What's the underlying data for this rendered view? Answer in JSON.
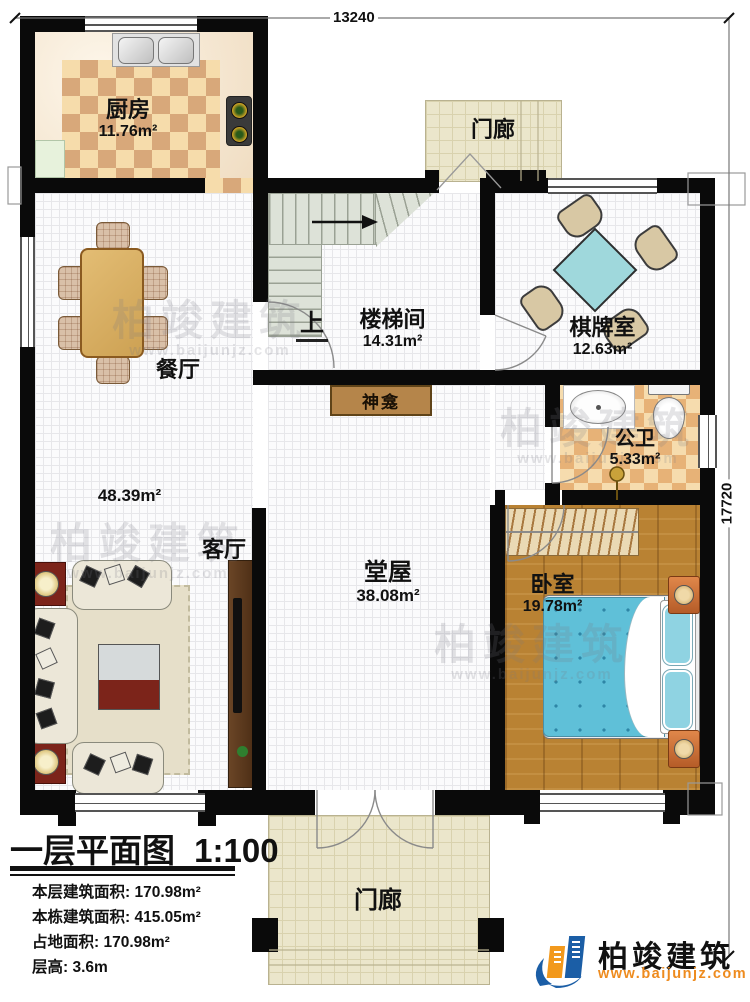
{
  "dimensions": {
    "width_label": "13240",
    "height_label": "17720"
  },
  "rooms": {
    "kitchen": {
      "name": "厨房",
      "area": "11.76m²"
    },
    "porch_top": {
      "name": "门廊"
    },
    "stairwell": {
      "name": "楼梯间",
      "area": "14.31m²",
      "direction_label": "上"
    },
    "chess_room": {
      "name": "棋牌室",
      "area": "12.63m²"
    },
    "dining": {
      "name": "餐厅"
    },
    "living": {
      "name": "客厅",
      "area": "48.39m²"
    },
    "bathroom": {
      "name": "公卫",
      "area": "5.33m²"
    },
    "hall": {
      "name": "堂屋",
      "area": "38.08m²"
    },
    "bedroom": {
      "name": "卧室",
      "area": "19.78m²"
    },
    "shrine": {
      "name": "神龛"
    },
    "porch_bottom": {
      "name": "门廊"
    }
  },
  "legend": {
    "title": "一层平面图",
    "scale": "1:100",
    "rows": [
      {
        "label": "本层建筑面积:",
        "value": "170.98m²"
      },
      {
        "label": "本栋建筑面积:",
        "value": "415.05m²"
      },
      {
        "label": "占地面积:",
        "value": "170.98m²"
      },
      {
        "label": "层高:",
        "value": "3.6m"
      }
    ]
  },
  "branding": {
    "company": "柏竣建筑",
    "website": "www.baijunjz.com"
  },
  "watermark": {
    "text": "柏竣建筑",
    "url": "www.baijunjz.com"
  },
  "colors": {
    "wall": "#0a0a0a",
    "bed": "#5fc0d8",
    "mahjong_table": "#9fd8dc",
    "wood_floor": "#b98233",
    "logo_blue": "#1b5ea6",
    "logo_orange": "#f2991c"
  }
}
